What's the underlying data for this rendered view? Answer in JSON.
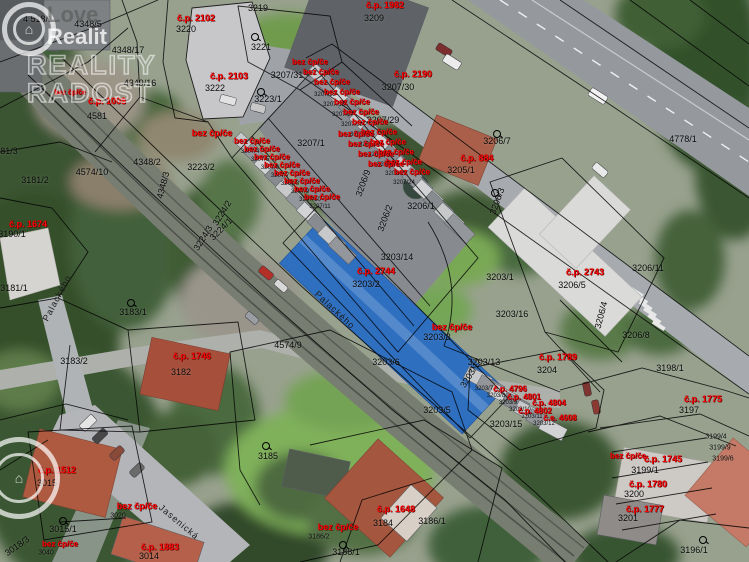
{
  "watermark": {
    "line1": "Love",
    "line2": "Realit",
    "line3": "REALITY",
    "line4": "RADOST"
  },
  "legend_colors": {
    "parcel_number": "#000000",
    "building_number": "#ff0000"
  },
  "map": {
    "parcel_labels": [
      {
        "text": "4 518/1",
        "x": 38,
        "y": 19
      },
      {
        "text": "4348/5",
        "x": 88,
        "y": 24
      },
      {
        "text": "4348/17",
        "x": 128,
        "y": 50
      },
      {
        "text": "4349/16",
        "x": 140,
        "y": 83
      },
      {
        "text": "4581",
        "x": 97,
        "y": 116
      },
      {
        "text": "3220",
        "x": 186,
        "y": 29
      },
      {
        "text": "3219",
        "x": 258,
        "y": 8
      },
      {
        "text": "3221",
        "x": 261,
        "y": 47
      },
      {
        "text": "3222",
        "x": 215,
        "y": 88
      },
      {
        "text": "3223/1",
        "x": 268,
        "y": 99
      },
      {
        "text": "3209",
        "x": 374,
        "y": 18
      },
      {
        "text": "3207/31",
        "x": 287,
        "y": 75
      },
      {
        "text": "3207/30",
        "x": 398,
        "y": 87
      },
      {
        "text": "3207/29",
        "x": 383,
        "y": 120
      },
      {
        "text": "3207/1",
        "x": 311,
        "y": 143
      },
      {
        "text": "3223/2",
        "x": 201,
        "y": 167
      },
      {
        "text": "4348/2",
        "x": 147,
        "y": 162
      },
      {
        "text": "4348/3",
        "x": 163,
        "y": 185,
        "rot": -75
      },
      {
        "text": "4574/10",
        "x": 92,
        "y": 172
      },
      {
        "text": "3181/2",
        "x": 35,
        "y": 180
      },
      {
        "text": "3181/3",
        "x": 4,
        "y": 151
      },
      {
        "text": "3190/1",
        "x": 12,
        "y": 234
      },
      {
        "text": "3181/1",
        "x": 14,
        "y": 288
      },
      {
        "text": "3224/2",
        "x": 222,
        "y": 213,
        "rot": -58
      },
      {
        "text": "3224/1",
        "x": 221,
        "y": 229,
        "rot": -45
      },
      {
        "text": "3224/3",
        "x": 203,
        "y": 238,
        "rot": -58
      },
      {
        "text": "3183/1",
        "x": 133,
        "y": 312
      },
      {
        "text": "3183/2",
        "x": 74,
        "y": 361
      },
      {
        "text": "3182",
        "x": 181,
        "y": 372
      },
      {
        "text": "4574/9",
        "x": 288,
        "y": 345
      },
      {
        "text": "3206/9",
        "x": 363,
        "y": 183,
        "rot": -70
      },
      {
        "text": "3206/2",
        "x": 385,
        "y": 218,
        "rot": -70
      },
      {
        "text": "3206/1",
        "x": 421,
        "y": 206
      },
      {
        "text": "3203/14",
        "x": 397,
        "y": 257
      },
      {
        "text": "3203/2",
        "x": 366,
        "y": 284
      },
      {
        "text": "3206/7",
        "x": 497,
        "y": 141
      },
      {
        "text": "3205/1",
        "x": 461,
        "y": 170
      },
      {
        "text": "3206/3",
        "x": 497,
        "y": 201,
        "rot": -70
      },
      {
        "text": "3203/1",
        "x": 500,
        "y": 277
      },
      {
        "text": "3203/16",
        "x": 512,
        "y": 314
      },
      {
        "text": "3203/3",
        "x": 437,
        "y": 337
      },
      {
        "text": "3203/6",
        "x": 386,
        "y": 362
      },
      {
        "text": "3203/5",
        "x": 437,
        "y": 410
      },
      {
        "text": "3203/15",
        "x": 506,
        "y": 424
      },
      {
        "text": "3203/13",
        "x": 484,
        "y": 362
      },
      {
        "text": "3203/17",
        "x": 471,
        "y": 373,
        "rot": -58
      },
      {
        "text": "3204",
        "x": 547,
        "y": 370
      },
      {
        "text": "3206/5",
        "x": 572,
        "y": 285
      },
      {
        "text": "3206/11",
        "x": 648,
        "y": 268
      },
      {
        "text": "3206/4",
        "x": 601,
        "y": 315,
        "rot": -75
      },
      {
        "text": "3206/8",
        "x": 636,
        "y": 335
      },
      {
        "text": "4778/1",
        "x": 683,
        "y": 139
      },
      {
        "text": "3198/1",
        "x": 670,
        "y": 368
      },
      {
        "text": "3197",
        "x": 689,
        "y": 410
      },
      {
        "text": "3199/1",
        "x": 645,
        "y": 470
      },
      {
        "text": "3200",
        "x": 634,
        "y": 494
      },
      {
        "text": "3201",
        "x": 628,
        "y": 518
      },
      {
        "text": "3196/1",
        "x": 694,
        "y": 550
      },
      {
        "text": "3185",
        "x": 268,
        "y": 456
      },
      {
        "text": "3184",
        "x": 383,
        "y": 523
      },
      {
        "text": "3186/1",
        "x": 432,
        "y": 521
      },
      {
        "text": "3186/2",
        "x": 319,
        "y": 537,
        "size": 7
      },
      {
        "text": "3188/1",
        "x": 346,
        "y": 552
      },
      {
        "text": "3015",
        "x": 47,
        "y": 483
      },
      {
        "text": "3015/1",
        "x": 63,
        "y": 529
      },
      {
        "text": "3018/3",
        "x": 17,
        "y": 546,
        "rot": -35
      },
      {
        "text": "3040",
        "x": 46,
        "y": 553,
        "size": 7
      },
      {
        "text": "3020",
        "x": 118,
        "y": 516,
        "size": 7
      },
      {
        "text": "3014",
        "x": 149,
        "y": 556
      },
      {
        "text": "3199/4",
        "x": 716,
        "y": 437,
        "size": 7
      },
      {
        "text": "3199/9",
        "x": 720,
        "y": 448,
        "size": 7
      },
      {
        "text": "3199/6",
        "x": 723,
        "y": 459,
        "size": 7
      }
    ],
    "garage_numbers": [
      {
        "text": "3207/4",
        "x": 250,
        "y": 152
      },
      {
        "text": "3207/5",
        "x": 260,
        "y": 160
      },
      {
        "text": "3207/6",
        "x": 270,
        "y": 168
      },
      {
        "text": "3207/7",
        "x": 280,
        "y": 176
      },
      {
        "text": "3207/8",
        "x": 290,
        "y": 184
      },
      {
        "text": "3207/9",
        "x": 300,
        "y": 192
      },
      {
        "text": "3207/10",
        "x": 310,
        "y": 200
      },
      {
        "text": "3207/11",
        "x": 320,
        "y": 207
      },
      {
        "text": "3207/15",
        "x": 325,
        "y": 95
      },
      {
        "text": "3207/16",
        "x": 334,
        "y": 105
      },
      {
        "text": "3207/17",
        "x": 343,
        "y": 115
      },
      {
        "text": "3207/18",
        "x": 352,
        "y": 125
      },
      {
        "text": "3207/19",
        "x": 361,
        "y": 135
      },
      {
        "text": "3207/20",
        "x": 370,
        "y": 145
      },
      {
        "text": "3207/21",
        "x": 379,
        "y": 155
      },
      {
        "text": "3207/22",
        "x": 388,
        "y": 165
      },
      {
        "text": "3207/23",
        "x": 396,
        "y": 174
      },
      {
        "text": "3207/24",
        "x": 404,
        "y": 183
      },
      {
        "text": "3203/7",
        "x": 484,
        "y": 389
      },
      {
        "text": "3203/8",
        "x": 496,
        "y": 396
      },
      {
        "text": "3203/9",
        "x": 508,
        "y": 403
      },
      {
        "text": "3203/10",
        "x": 520,
        "y": 410
      },
      {
        "text": "3203/11",
        "x": 532,
        "y": 417
      },
      {
        "text": "3203/12",
        "x": 544,
        "y": 424
      }
    ],
    "building_labels": [
      {
        "text": "č.p. 2102",
        "x": 196,
        "y": 18
      },
      {
        "text": "č.p. 2103",
        "x": 229,
        "y": 76
      },
      {
        "text": "č.p. 1982",
        "x": 385,
        "y": 5
      },
      {
        "text": "č.p. 2190",
        "x": 413,
        "y": 74
      },
      {
        "text": "č.p. 1008",
        "x": 107,
        "y": 101
      },
      {
        "text": "bez čp/če",
        "x": 70,
        "y": 93,
        "size": 7
      },
      {
        "text": "č.p. 1674",
        "x": 28,
        "y": 224
      },
      {
        "text": "č.p. 884",
        "x": 477,
        "y": 158
      },
      {
        "text": "č.p. 2744",
        "x": 376,
        "y": 271
      },
      {
        "text": "č.p. 2743",
        "x": 585,
        "y": 272
      },
      {
        "text": "bez čp/če",
        "x": 452,
        "y": 327
      },
      {
        "text": "č.p. 1746",
        "x": 192,
        "y": 356
      },
      {
        "text": "č.p. 1789",
        "x": 558,
        "y": 357
      },
      {
        "text": "č.p. 1775",
        "x": 703,
        "y": 399
      },
      {
        "text": "bez čp/če",
        "x": 628,
        "y": 456,
        "size": 8
      },
      {
        "text": "č.p. 1745",
        "x": 663,
        "y": 459
      },
      {
        "text": "č.p. 1780",
        "x": 648,
        "y": 484
      },
      {
        "text": "č.p. 1777",
        "x": 645,
        "y": 509
      },
      {
        "text": "č.p. 1512",
        "x": 57,
        "y": 470
      },
      {
        "text": "bez čp/če",
        "x": 137,
        "y": 506
      },
      {
        "text": "bez čp/če",
        "x": 60,
        "y": 544,
        "size": 8
      },
      {
        "text": "č.p. 1883",
        "x": 160,
        "y": 547
      },
      {
        "text": "č.p. 1648",
        "x": 396,
        "y": 509
      },
      {
        "text": "bez čp/če",
        "x": 338,
        "y": 527
      },
      {
        "text": "bez čp/če",
        "x": 212,
        "y": 133
      },
      {
        "text": "č.p. 4796",
        "x": 510,
        "y": 389,
        "size": 8
      },
      {
        "text": "č.p. 4801",
        "x": 524,
        "y": 397,
        "size": 8
      },
      {
        "text": "č.p. 4804",
        "x": 549,
        "y": 403,
        "size": 8
      },
      {
        "text": "č.p. 4802",
        "x": 535,
        "y": 411,
        "size": 8
      },
      {
        "text": "č.e. 4608",
        "x": 560,
        "y": 418,
        "size": 8
      },
      {
        "text": "bez čp/če",
        "x": 310,
        "y": 62,
        "size": 8
      },
      {
        "text": "bez čp/če",
        "x": 321,
        "y": 72,
        "size": 8
      },
      {
        "text": "bez čp/če",
        "x": 332,
        "y": 82,
        "size": 8
      },
      {
        "text": "bez čp/če",
        "x": 342,
        "y": 92,
        "size": 8
      },
      {
        "text": "bez čp/če",
        "x": 352,
        "y": 102,
        "size": 8
      },
      {
        "text": "bez čp/če",
        "x": 361,
        "y": 112,
        "size": 8
      },
      {
        "text": "bez čp/če",
        "x": 370,
        "y": 122,
        "size": 8
      },
      {
        "text": "bez čp/če",
        "x": 379,
        "y": 132,
        "size": 8
      },
      {
        "text": "bez čp/če",
        "x": 388,
        "y": 142,
        "size": 8
      },
      {
        "text": "bez čp/če",
        "x": 396,
        "y": 152,
        "size": 8
      },
      {
        "text": "bez čp/če",
        "x": 404,
        "y": 162,
        "size": 8
      },
      {
        "text": "bez čp/če",
        "x": 412,
        "y": 172,
        "size": 8
      },
      {
        "text": "bez čp/če",
        "x": 252,
        "y": 141,
        "size": 8
      },
      {
        "text": "bez čp/če",
        "x": 262,
        "y": 149,
        "size": 8
      },
      {
        "text": "bez čp/če",
        "x": 272,
        "y": 157,
        "size": 8
      },
      {
        "text": "bez čp/če",
        "x": 282,
        "y": 165,
        "size": 8
      },
      {
        "text": "bez čp/če",
        "x": 292,
        "y": 173,
        "size": 8
      },
      {
        "text": "bez čp/če",
        "x": 302,
        "y": 181,
        "size": 8
      },
      {
        "text": "bez čp/če",
        "x": 312,
        "y": 189,
        "size": 8
      },
      {
        "text": "bez čp/če",
        "x": 322,
        "y": 197,
        "size": 8
      },
      {
        "text": "bez čp/če",
        "x": 356,
        "y": 134,
        "size": 8
      },
      {
        "text": "bez čp/če",
        "x": 366,
        "y": 144,
        "size": 8
      },
      {
        "text": "bez čp/če",
        "x": 376,
        "y": 154,
        "size": 8
      },
      {
        "text": "bez čp/če",
        "x": 386,
        "y": 164,
        "size": 8
      }
    ],
    "street_labels": [
      {
        "text": "Palackého",
        "x": 57,
        "y": 298,
        "rot": -62
      },
      {
        "text": "Palackého",
        "x": 335,
        "y": 310,
        "rot": 43
      },
      {
        "text": "Jasenická",
        "x": 179,
        "y": 522,
        "rot": 40
      }
    ],
    "landuse_symbols": [
      {
        "x": 255,
        "y": 37
      },
      {
        "x": 261,
        "y": 92
      },
      {
        "x": 497,
        "y": 134
      },
      {
        "x": 495,
        "y": 193
      },
      {
        "x": 131,
        "y": 303
      },
      {
        "x": 266,
        "y": 446
      },
      {
        "x": 343,
        "y": 545
      },
      {
        "x": 703,
        "y": 540
      },
      {
        "x": 63,
        "y": 521
      }
    ]
  }
}
